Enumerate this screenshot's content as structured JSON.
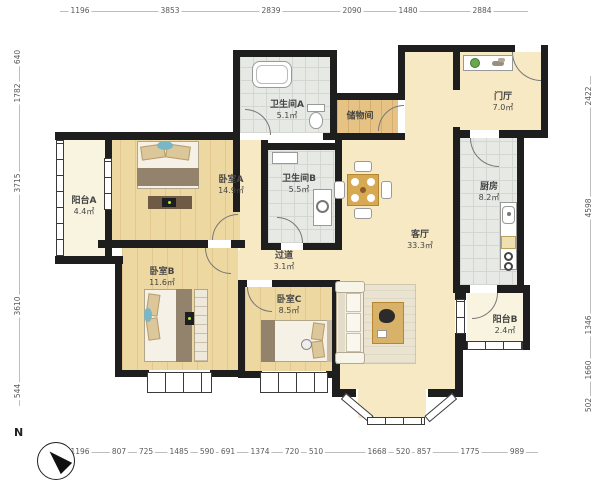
{
  "compass": {
    "label": "N"
  },
  "rooms": {
    "balcony_a": {
      "name": "阳台A",
      "area": "4.4㎡"
    },
    "bedroom_a": {
      "name": "卧室A",
      "area": "14.9㎡"
    },
    "bathroom_a": {
      "name": "卫生间A",
      "area": "5.1㎡"
    },
    "storage": {
      "name": "储物间"
    },
    "foyer": {
      "name": "门厅",
      "area": "7.0㎡"
    },
    "kitchen": {
      "name": "厨房",
      "area": "8.2㎡"
    },
    "bathroom_b": {
      "name": "卫生间B",
      "area": "5.5㎡"
    },
    "living_room": {
      "name": "客厅",
      "area": "33.3㎡"
    },
    "hallway": {
      "name": "过道",
      "area": "3.1㎡"
    },
    "bedroom_b": {
      "name": "卧室B",
      "area": "11.6㎡"
    },
    "bedroom_c": {
      "name": "卧室C",
      "area": "8.5㎡"
    },
    "balcony_b": {
      "name": "阳台B",
      "area": "2.4㎡"
    }
  },
  "dimensions": {
    "top": [
      "1196",
      "3853",
      "2839",
      "2090",
      "1480",
      "2884"
    ],
    "bottom": [
      "1196",
      "807",
      "725",
      "1485",
      "590",
      "691",
      "1374",
      "720",
      "510",
      "1668",
      "520",
      "857",
      "1775",
      "989"
    ],
    "left": [
      "640",
      "1782",
      "3715",
      "3610",
      "544"
    ],
    "right": [
      "2422",
      "4598",
      "1346",
      "1660",
      "502"
    ]
  }
}
